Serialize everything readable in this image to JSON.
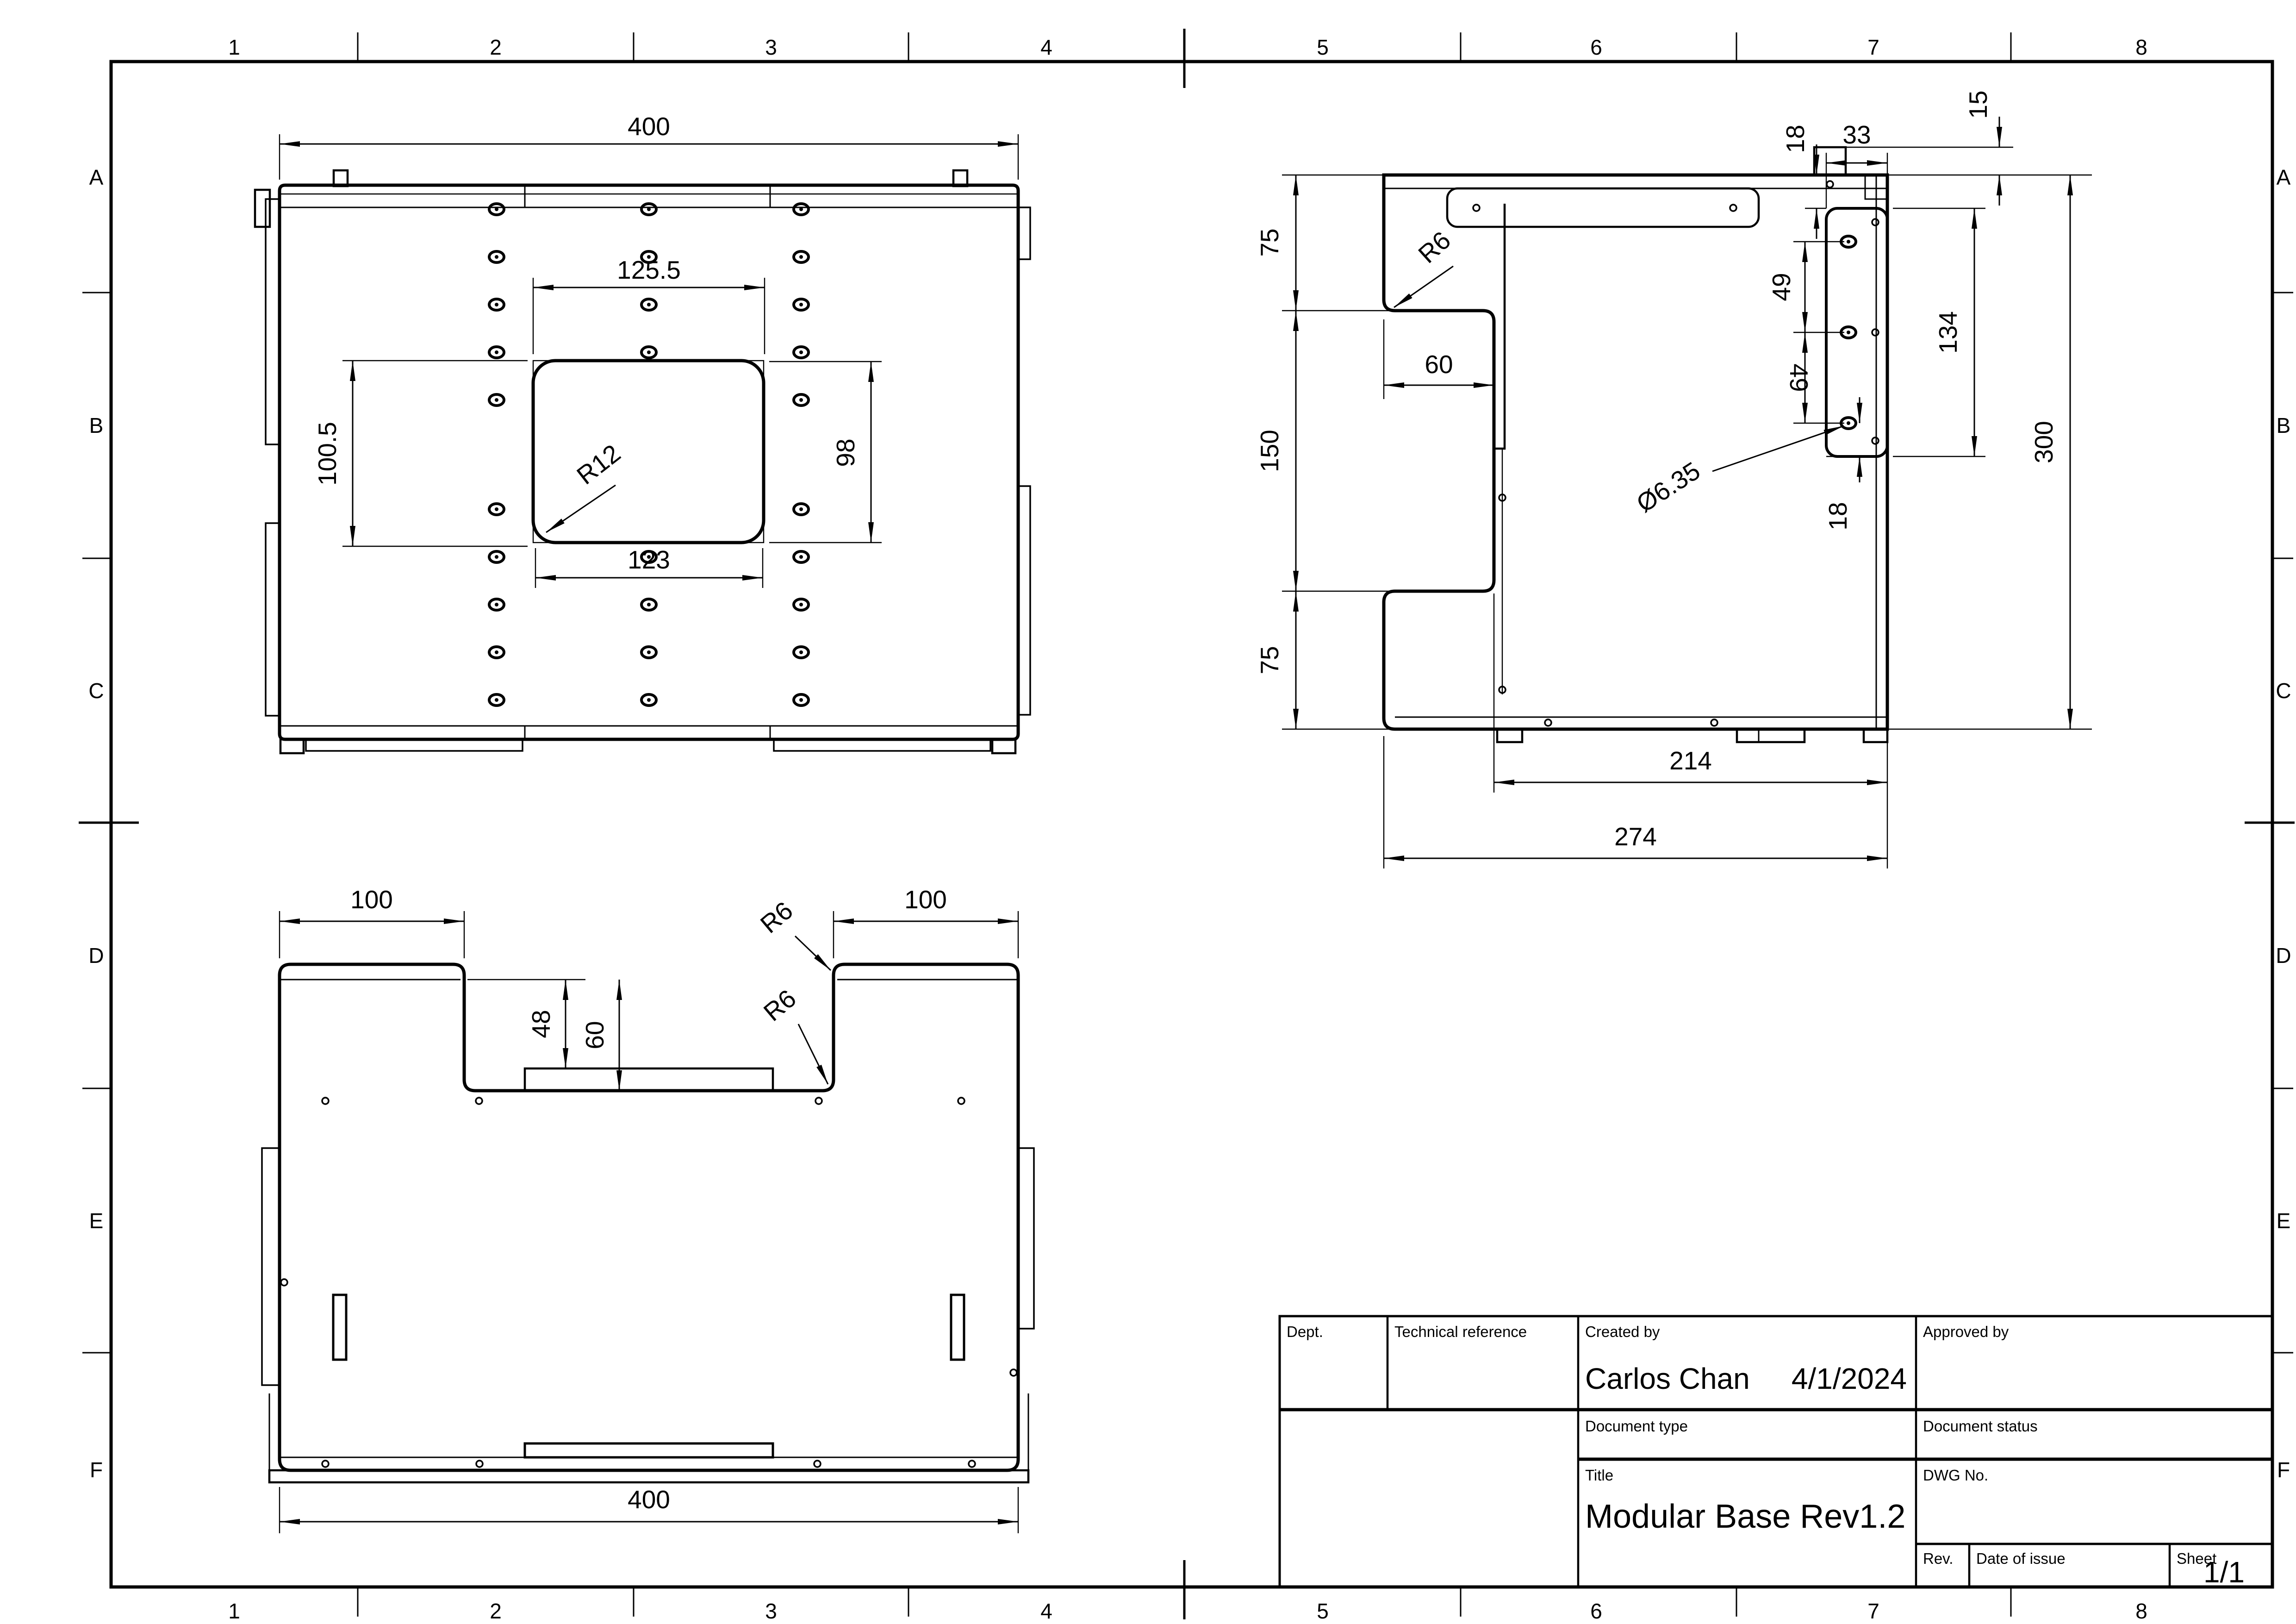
{
  "sheet": {
    "zones": {
      "cols": [
        "1",
        "2",
        "3",
        "4",
        "5",
        "6",
        "7",
        "8"
      ],
      "rows": [
        "A",
        "B",
        "C",
        "D",
        "E",
        "F"
      ]
    }
  },
  "views": {
    "top": {
      "dims": {
        "width": "400",
        "cutout_top": "125.5",
        "cutout_left": "100.5",
        "cutout_right": "98",
        "cutout_bottom": "123",
        "corner_radius": "R12"
      }
    },
    "side": {
      "dims": {
        "upper": "75",
        "middle": "150",
        "lower": "75",
        "step_width": "60",
        "step_fillet": "R6",
        "tab_height": "15",
        "flange_width": "33",
        "flange_top_offset": "18",
        "hole_pitch_1": "49",
        "hole_pitch_2": "49",
        "flange_height": "134",
        "total_height": "300",
        "hole_diameter": "Ø6.35",
        "hole_bottom_offset": "18",
        "inner_width": "214",
        "outer_width": "274"
      }
    },
    "front": {
      "dims": {
        "left_shoulder": "100",
        "right_shoulder": "100",
        "notch_inner_depth": "48",
        "notch_depth": "60",
        "notch_fillet_top": "R6",
        "notch_fillet_bottom": "R6",
        "width": "400"
      }
    }
  },
  "title_block": {
    "labels": {
      "dept": "Dept.",
      "technical_reference": "Technical reference",
      "created_by": "Created by",
      "approved_by": "Approved by",
      "document_type": "Document type",
      "document_status": "Document status",
      "title": "Title",
      "dwg_no": "DWG No.",
      "rev": "Rev.",
      "date_of_issue": "Date of issue",
      "sheet": "Sheet"
    },
    "values": {
      "created_by_name": "Carlos Chan",
      "created_date": "4/1/2024",
      "title": "Modular Base Rev1.2",
      "sheet_number": "1/1"
    }
  }
}
